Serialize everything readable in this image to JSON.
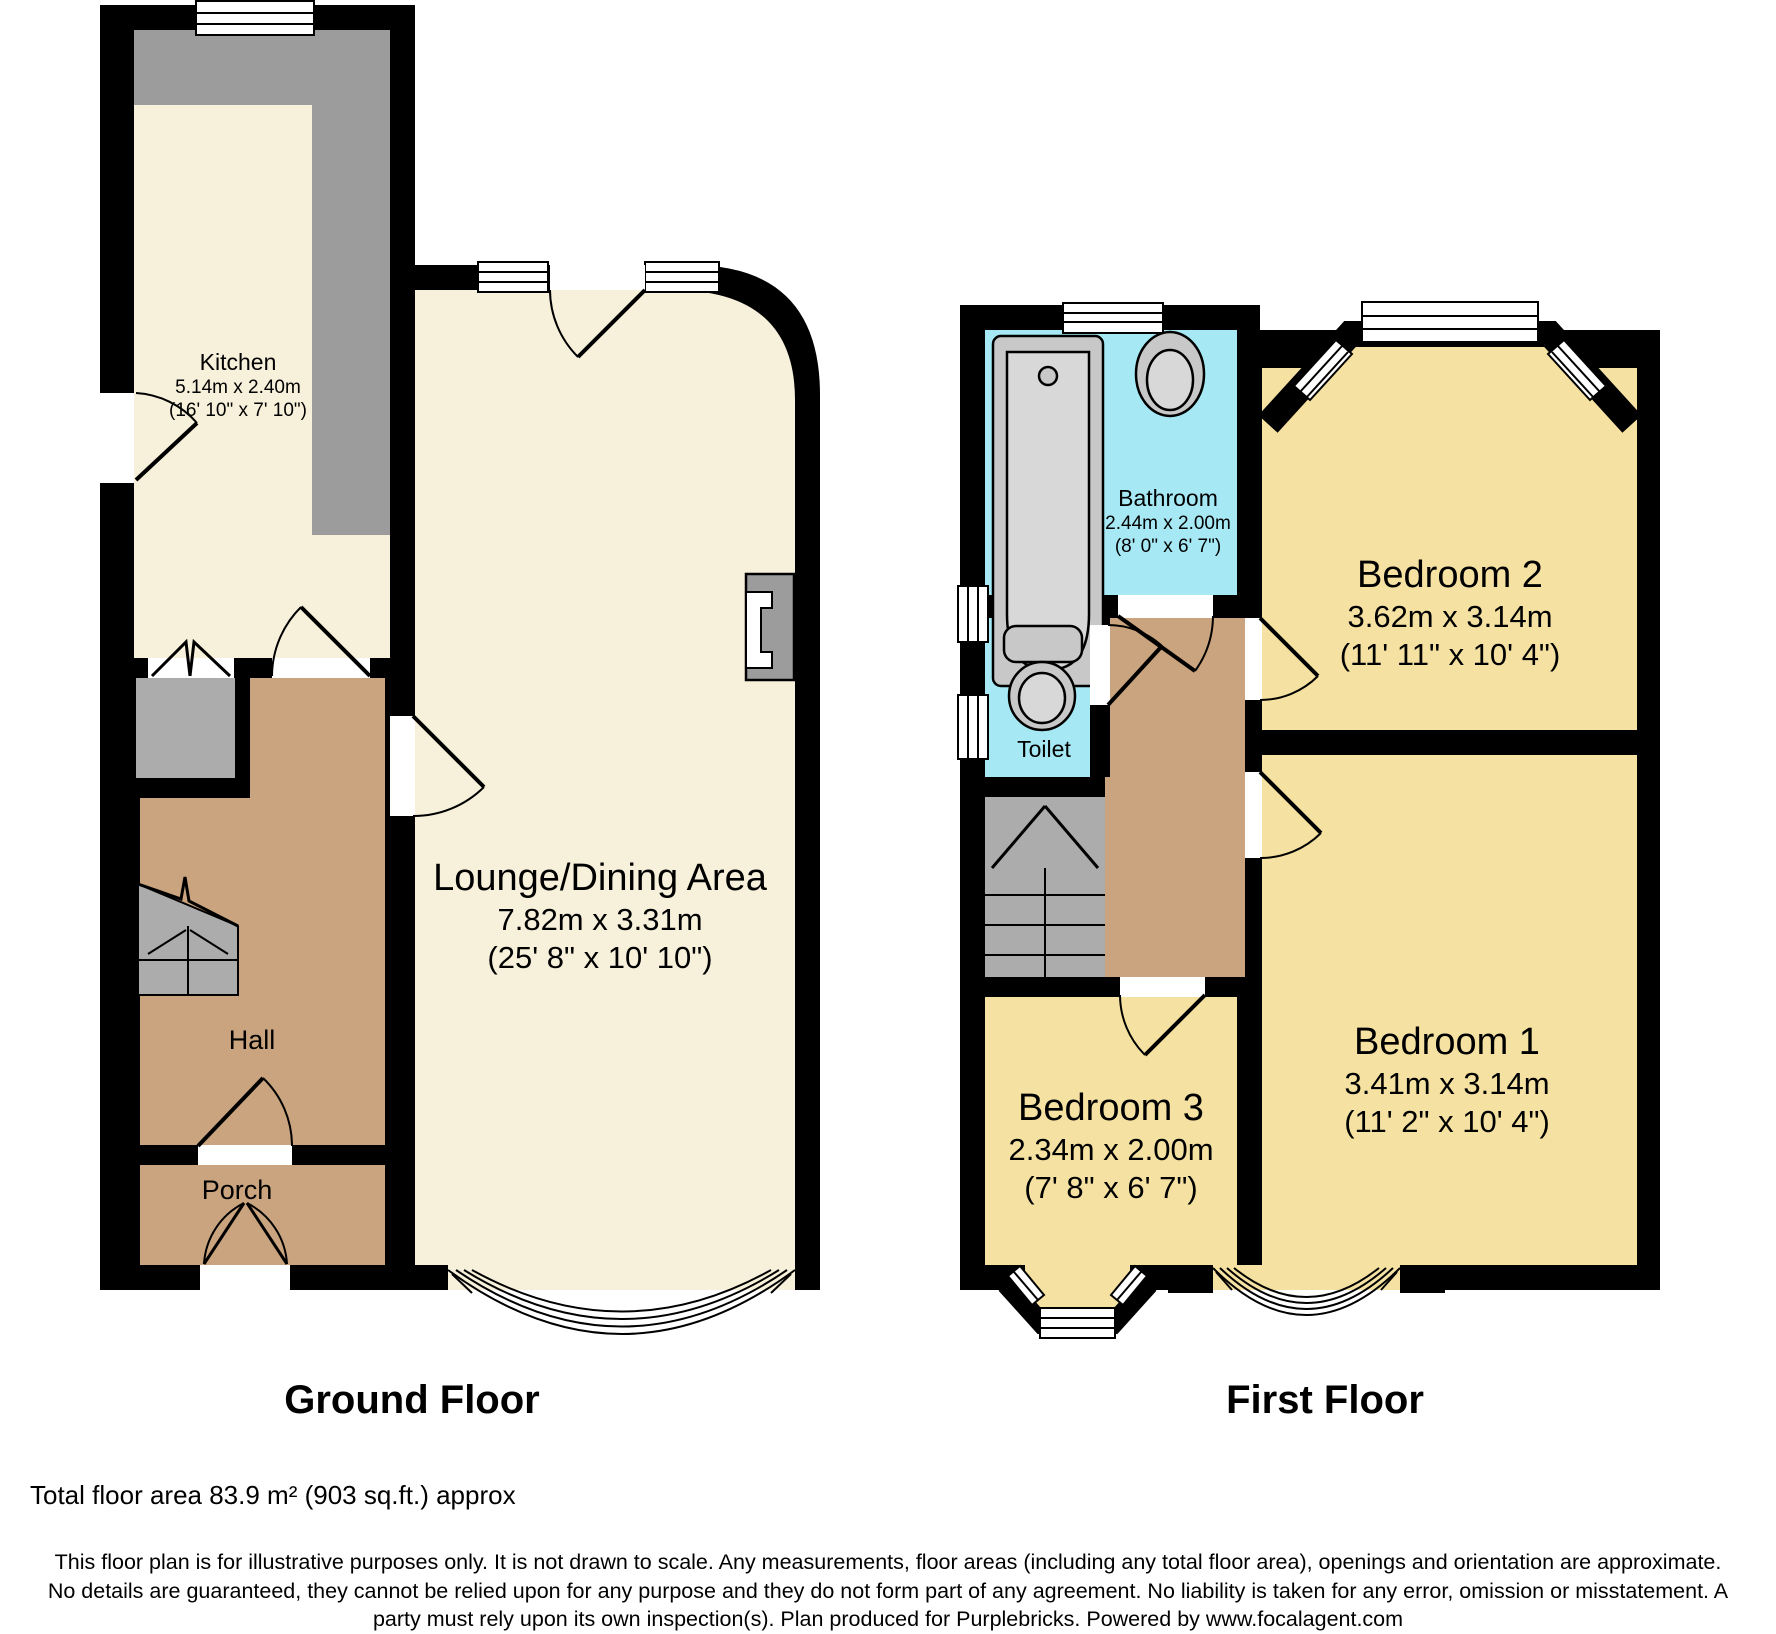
{
  "floors": {
    "ground": {
      "title": "Ground Floor"
    },
    "first": {
      "title": "First Floor"
    }
  },
  "rooms": {
    "kitchen": {
      "name": "Kitchen",
      "metric": "5.14m x 2.40m",
      "imperial": "(16' 10\" x 7' 10\")"
    },
    "lounge": {
      "name": "Lounge/Dining Area",
      "metric": "7.82m x 3.31m",
      "imperial": "(25' 8\" x 10' 10\")"
    },
    "hall": {
      "name": "Hall"
    },
    "porch": {
      "name": "Porch"
    },
    "bathroom": {
      "name": "Bathroom",
      "metric": "2.44m x 2.00m",
      "imperial": "(8' 0\" x 6' 7\")"
    },
    "toilet": {
      "name": "Toilet"
    },
    "bedroom2": {
      "name": "Bedroom 2",
      "metric": "3.62m x 3.14m",
      "imperial": "(11' 11\" x 10' 4\")"
    },
    "bedroom1": {
      "name": "Bedroom 1",
      "metric": "3.41m x 3.14m",
      "imperial": "(11' 2\" x 10' 4\")"
    },
    "bedroom3": {
      "name": "Bedroom 3",
      "metric": "2.34m x 2.00m",
      "imperial": "(7' 8\" x 6' 7\")"
    }
  },
  "footer": {
    "total_area": "Total floor area 83.9 m² (903 sq.ft.) approx",
    "disclaimer": "This floor plan is for illustrative purposes only. It is not drawn to scale. Any measurements, floor areas (including any total floor area), openings and orientation are approximate. No details are guaranteed, they cannot be relied upon for any purpose and they do not form part of any agreement. No liability is taken for any error, omission or misstatement. A party must rely upon its own inspection(s). Plan produced for Purplebricks. Powered by www.focalagent.com"
  },
  "colors": {
    "wall": "#000000",
    "ground_room": "#F7F0DA",
    "hallway": "#C9A47E",
    "bedroom": "#F5E2A2",
    "wet_room": "#A6E9F4",
    "counter_gray": "#9C9C9C",
    "stairs_gray": "#ACACAC",
    "fixture": "#C8C8C8",
    "fixture_inner": "#D8D8D8"
  }
}
